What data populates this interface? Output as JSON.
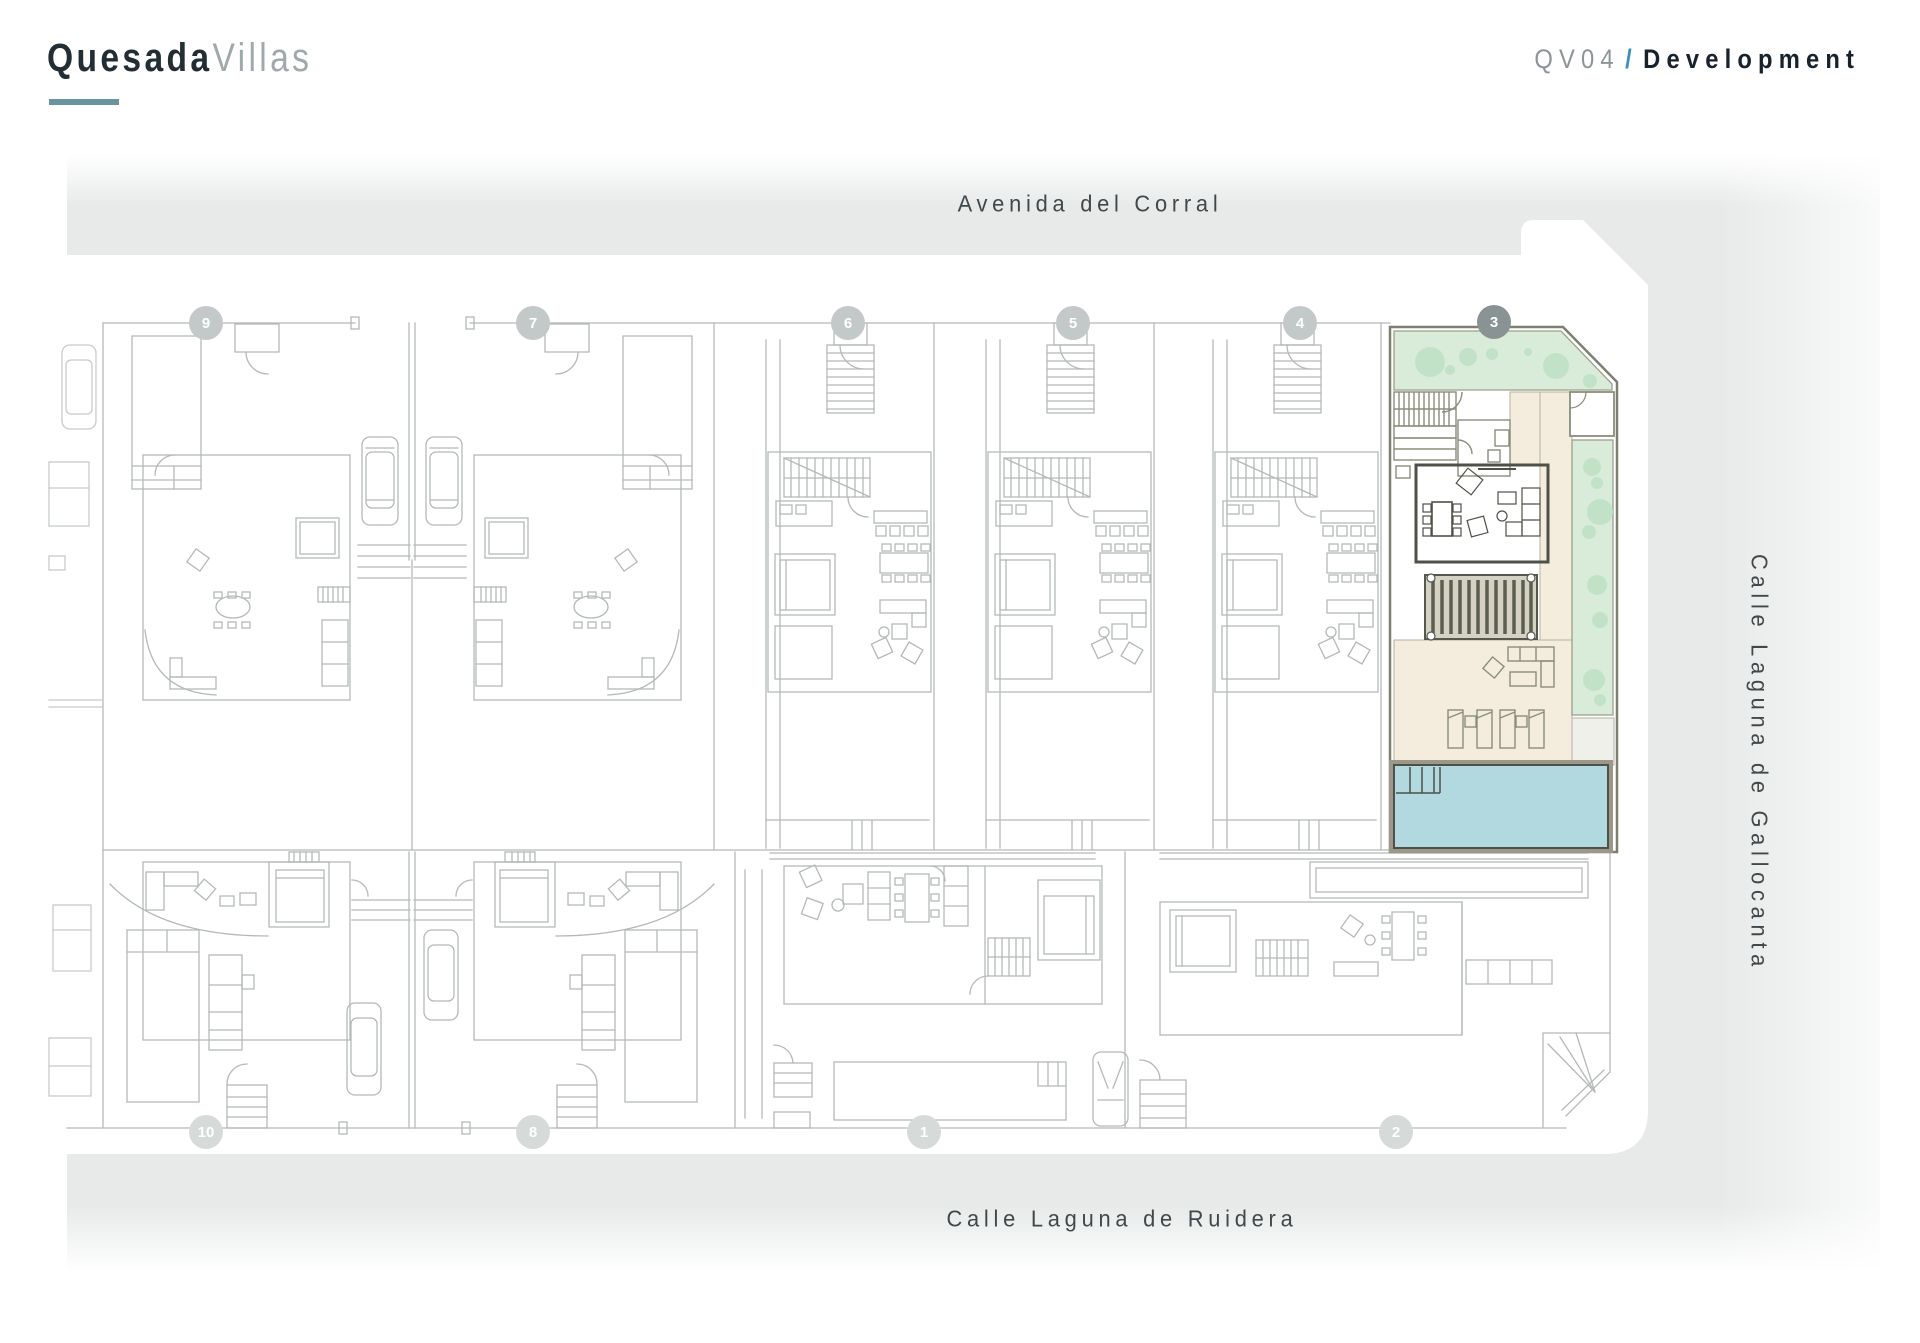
{
  "header": {
    "brand_primary": "Quesada",
    "brand_secondary": "Villas",
    "project_code": "QV04",
    "separator": "/",
    "project_label": "Development"
  },
  "map": {
    "streets": {
      "top": "Avenida del Corral",
      "bottom": "Calle Laguna de Ruidera",
      "right": "Calle Laguna de Gallocanta"
    },
    "highlighted_plot": "3",
    "plots": [
      {
        "number": "9"
      },
      {
        "number": "7"
      },
      {
        "number": "6"
      },
      {
        "number": "5"
      },
      {
        "number": "4"
      },
      {
        "number": "3"
      },
      {
        "number": "10"
      },
      {
        "number": "8"
      },
      {
        "number": "1"
      },
      {
        "number": "2"
      }
    ]
  },
  "theme": {
    "accent": "#68949f",
    "slash": "#3a8fc0",
    "ink": "#222e34",
    "ink2": "#18222c",
    "muted": "#8d9599",
    "muted2": "#9fa9ab",
    "street": "#41484c",
    "panel": "#e7eae9",
    "line": "#b4b9b8",
    "lineSoft": "#c6cbca",
    "green": "#d9ecd9",
    "tree": "#c2e2c8",
    "pool": "#b2d8e0",
    "beige": "#f4eddd",
    "olive": "#8a8d7b",
    "dark": "#4e5147",
    "badge": "#c3c9c8",
    "badgeLow": "#d6dbda",
    "badgeHl": "#8a9394"
  }
}
